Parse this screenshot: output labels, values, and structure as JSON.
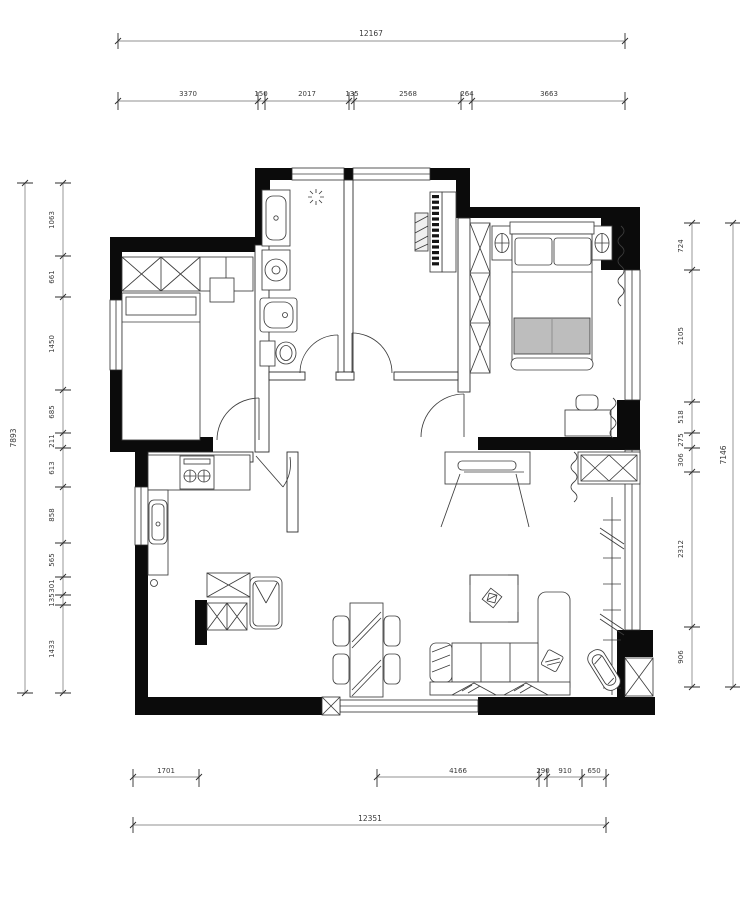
{
  "title": "apartment-floor-plan",
  "colors": {
    "wall": "#0b0b0b",
    "line": "#3d3d3d",
    "blanket": "#bdbdbd",
    "background": "#ffffff"
  },
  "dimensions": {
    "top": {
      "total": "12167",
      "segments": [
        "3370",
        "150",
        "2017",
        "135",
        "2568",
        "264",
        "3663"
      ]
    },
    "bottom": {
      "total": "12351",
      "segments": [
        "1701",
        "4166",
        "290",
        "910",
        "650"
      ]
    },
    "left": {
      "total": "7893",
      "segments": [
        "1063",
        "661",
        "1450",
        "685",
        "211",
        "613",
        "858",
        "565",
        "301",
        "135",
        "1433"
      ]
    },
    "right": {
      "total": "7146",
      "segments": [
        "724",
        "2105",
        "518",
        "275",
        "306",
        "2312",
        "906"
      ]
    }
  }
}
